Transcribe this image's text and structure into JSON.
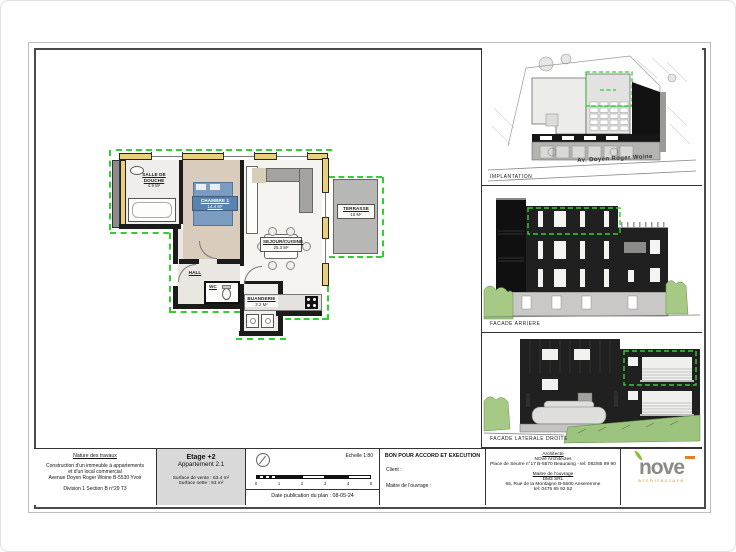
{
  "plan": {
    "rooms": {
      "douche": {
        "name": "SALLE DE DOUCHE",
        "area": "4.9 m²"
      },
      "chambre": {
        "name": "CHAMBRE 1",
        "area": "14.4 m²"
      },
      "sejour": {
        "name": "SEJOUR/CUISINE",
        "area": "25.3 m²"
      },
      "hall": {
        "name": "HALL"
      },
      "wc": {
        "name": "WC"
      },
      "buanderie": {
        "name": "BUANDERIE",
        "area": "3.2 m²"
      },
      "terrasse": {
        "name": "TERRASSE",
        "area": "10 m²"
      }
    }
  },
  "views": {
    "implantation": {
      "label": "IMPLANTATION",
      "street": "Av. Doyen Roger Woine"
    },
    "facade_arriere": {
      "label": "FACADE ARRIERE"
    },
    "facade_laterale": {
      "label": "FACADE LATERALE DROITE"
    }
  },
  "title_block": {
    "nature": {
      "title": "Nature des travaux",
      "line1": "Construction d'un immeuble à appartements",
      "line2": "et d'un local commercial",
      "line3": "Avenue Doyen Roger Woine B-5530 Yvoir",
      "line4": "Division 1 Section B n°29 T3"
    },
    "etage": {
      "title": "Etage +2",
      "subtitle": "Appartement 2.1",
      "surface1": "Surface de vente : 63.4 m²",
      "surface2": "Surface nette : 53 m²"
    },
    "scale": {
      "echelle": "Echelle 1:80",
      "date": "Date publication du plan : 08-05-24",
      "bar_numbers": [
        "0",
        "1",
        "2",
        "3",
        "4",
        "5"
      ]
    },
    "approval": {
      "title": "BON POUR ACCORD ET EXECUTION",
      "client": "Client :",
      "maitre": "Maitre de l'ouvrage :"
    },
    "contacts": {
      "architecte_title": "Architecte",
      "architecte_name": "NOvé Architectes",
      "architecte_address": "Place de Seurre n°17 B-5570 Beauraing - tel: 082/85 99 90",
      "mo_title": "Maitre de l'ouvrage",
      "mo_name": "DM3 SRL",
      "mo_address": "65, Rue de la Montagne B-5500 Anseremme",
      "mo_tel": "tel: 0475 65 92 52"
    },
    "logo": {
      "name": "nove",
      "sub": "architecture"
    }
  },
  "colors": {
    "accent_green": "#2fd02f",
    "wall_yellow": "#e8d07c",
    "facade_black": "#1f1f1f",
    "logo_gray": "#8b8b86",
    "logo_green": "#8cbf3f",
    "logo_orange": "#e2801f"
  }
}
